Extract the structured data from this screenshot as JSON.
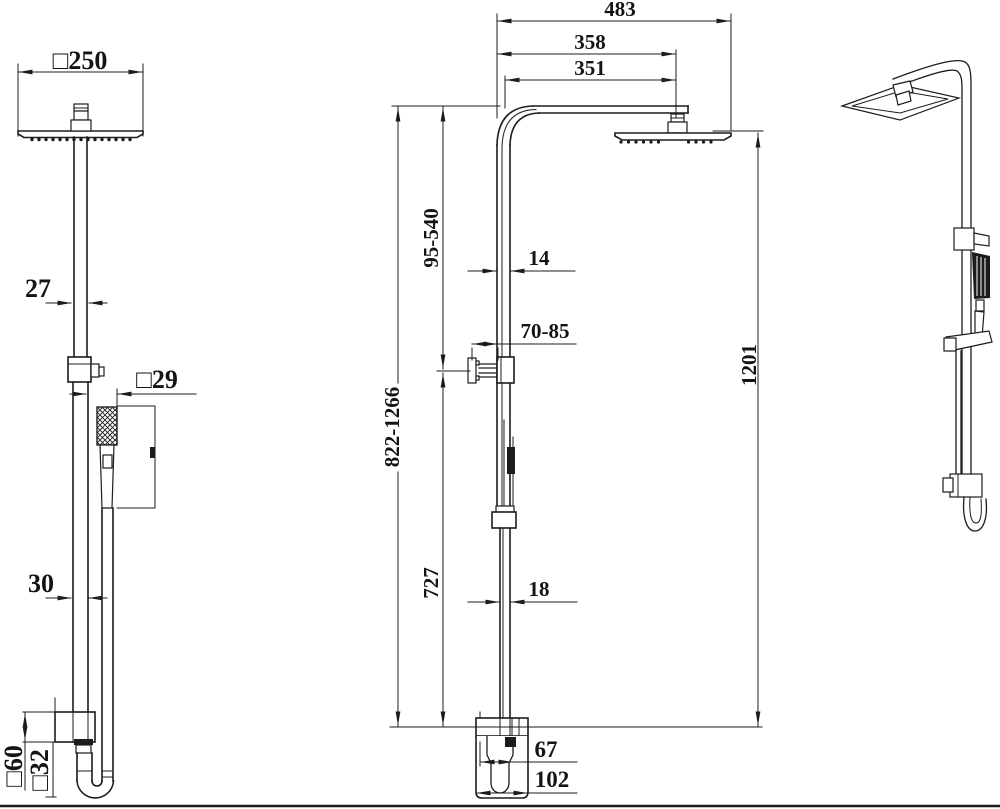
{
  "colors": {
    "ink": "#1c1c1c",
    "paper": "#ffffff"
  },
  "labels": {
    "sq250": "□250",
    "d27": "27",
    "sq29": "□29",
    "d30": "30",
    "sq60": "□60",
    "sq32": "□32",
    "d483": "483",
    "d358": "358",
    "d351": "351",
    "r95_540": "95-540",
    "d14": "14",
    "r70_85": "70-85",
    "r822_1266": "822-1266",
    "d1201": "1201",
    "d727": "727",
    "d18": "18",
    "d67": "67",
    "d102": "102"
  }
}
